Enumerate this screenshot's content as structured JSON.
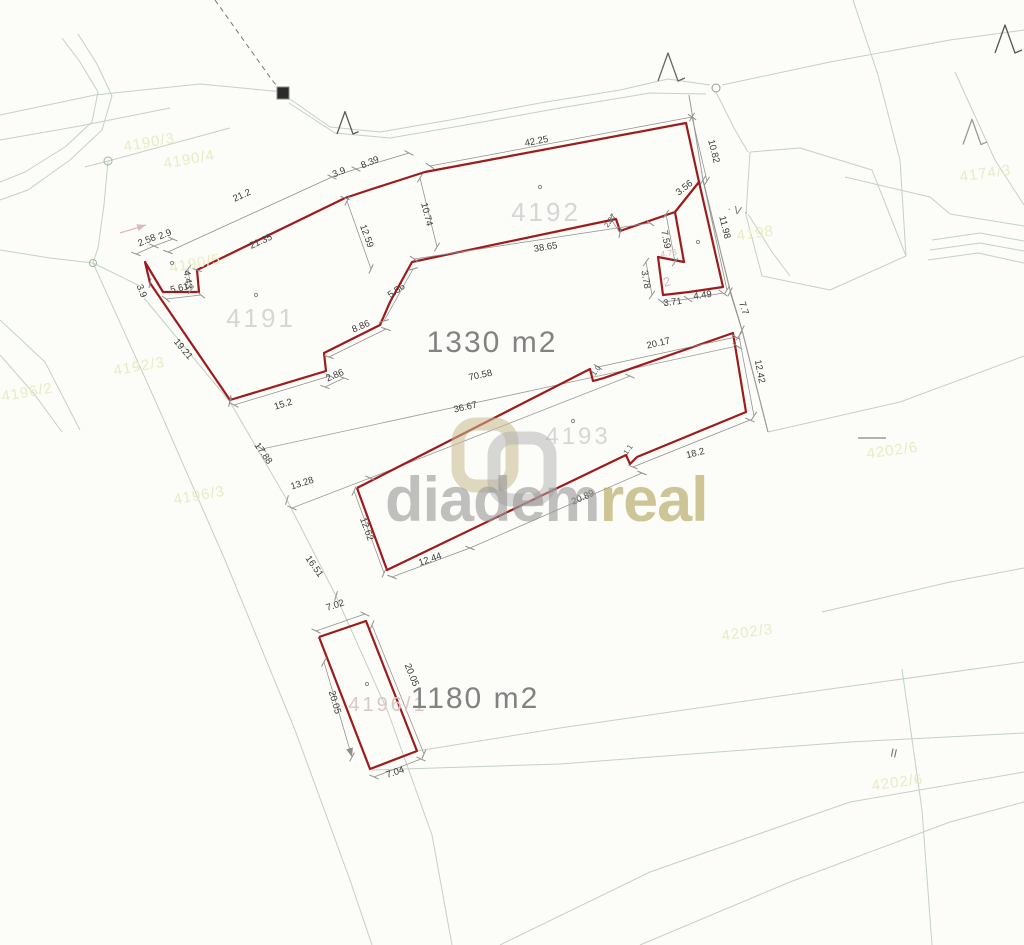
{
  "watermark": {
    "brand_gray": "diadem",
    "brand_olive": "real"
  },
  "areas": {
    "main": "1330 m2",
    "bottom": "1180 m2"
  },
  "parcel_numbers": {
    "p4191": "4191",
    "p4192": "4192",
    "p4193": "4193",
    "p4196_1": "4196/1"
  },
  "dimensions": {
    "d21_2": "21.2",
    "d21_35": "21.35",
    "d3_9a": "3.9",
    "d8_39": "8.39",
    "d42_25": "42.25",
    "d10_82": "10.82",
    "d3_56": "3.56",
    "d11_98": "11.98",
    "d7_59": "7.59",
    "d4_76": "4.76",
    "d3_78": "3.78",
    "d3_71": "3.71",
    "d4_49": "4.49",
    "d7_7": "7.7",
    "d2_58": "2.58",
    "d2_9": "2.9",
    "d4_43": "4.43",
    "d5_61": "5.61",
    "d3_9b": "3.9",
    "d19_21": "19.21",
    "d12_59": "12.59",
    "d10_74": "10.74",
    "d38_65": "38.65",
    "d5_56": "5.56",
    "d8_86": "8.86",
    "d2_86": "2.86",
    "d15_2": "15.2",
    "d2_27": "2.27",
    "d20_17": "20.17",
    "d12_42": "12.42",
    "d18_2": "18.2",
    "d20_89": "20.89",
    "d70_58": "70.58",
    "d36_67": "36.67",
    "d17_88": "17.88",
    "d13_28": "13.28",
    "d16_51": "16.51",
    "d12_62": "12.62",
    "d12_44": "12.44",
    "d7_02": "7.02",
    "d20_05a": "20.05",
    "d20_05b": "20.05",
    "d7_04": "7.04",
    "d1_0": "1.0",
    "d1_1": "1.1"
  },
  "underlay_labels": {
    "u1": "4190/3",
    "u2": "4190/4",
    "u3": "4190/5",
    "u4": "4192/3",
    "u5": "4196/2",
    "u6": "4196/3",
    "u7": "4174/3",
    "u8": "4198",
    "u9": "4202/3",
    "u10": "4202/6",
    "u11": "4202/6"
  },
  "symbols": {
    "double_bar": "II",
    "v_mark": "· V ·",
    "faint_glyph": "2"
  },
  "colors": {
    "parcel_outline": "#9e1b1b",
    "dimension_line": "#8f8f8f",
    "dimension_text": "#3a3a3a",
    "boundary_line": "#9b9b9b",
    "background_line": "#c3d2c3",
    "watermark_gray": "#9a9a9a",
    "watermark_olive": "#b2a45c",
    "underlay_label": "#e9ecc2",
    "faint_pink": "#d9b9c2",
    "parcel_number_gray": "#d6d6d6",
    "parcel_number_pink": "#dcc6c6"
  }
}
